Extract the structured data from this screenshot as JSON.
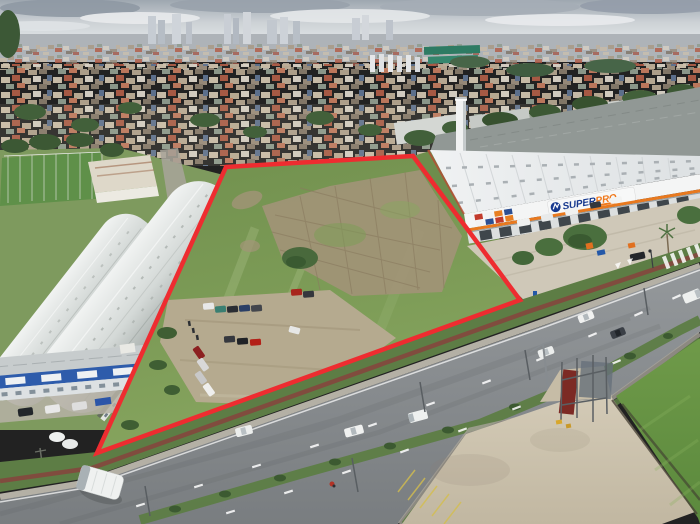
{
  "scene": {
    "description": "Aerial drone photograph of a vacant land parcel outlined in red, set between curved-roof industrial warehouses, a Super Pro warehouse store and a multi-lane highway, with a dense city skyline on the horizon",
    "parcel": {
      "outline_color": "#ee2c30",
      "outline_width": "4.5",
      "points": "226,167 413,156 520,300 97,453"
    },
    "signage": {
      "brand_part1": "SUPER",
      "brand_part2": "PRO",
      "brand_color1": "#16388e",
      "brand_color2": "#f0791c",
      "sign_background": "#f7f8f8",
      "facade_stripe": "#e8791f"
    },
    "palette": {
      "sky": "#c6cbd0",
      "cloud": "#e9ebed",
      "city_haze": "#aeb3b8",
      "lot_grass": "#7d9c57",
      "bright_grass": "#6f9a49",
      "dirt": "#b5aa8f",
      "road": "#8e9295",
      "median": "#5d7d45",
      "bike_path": "#84473d",
      "roof_white": "#eef0f1",
      "roof_back": "#919895",
      "barrel_roof": "#dfe3e1",
      "office_blue": "#2e5cab",
      "concrete": "#cfc8b8"
    }
  }
}
